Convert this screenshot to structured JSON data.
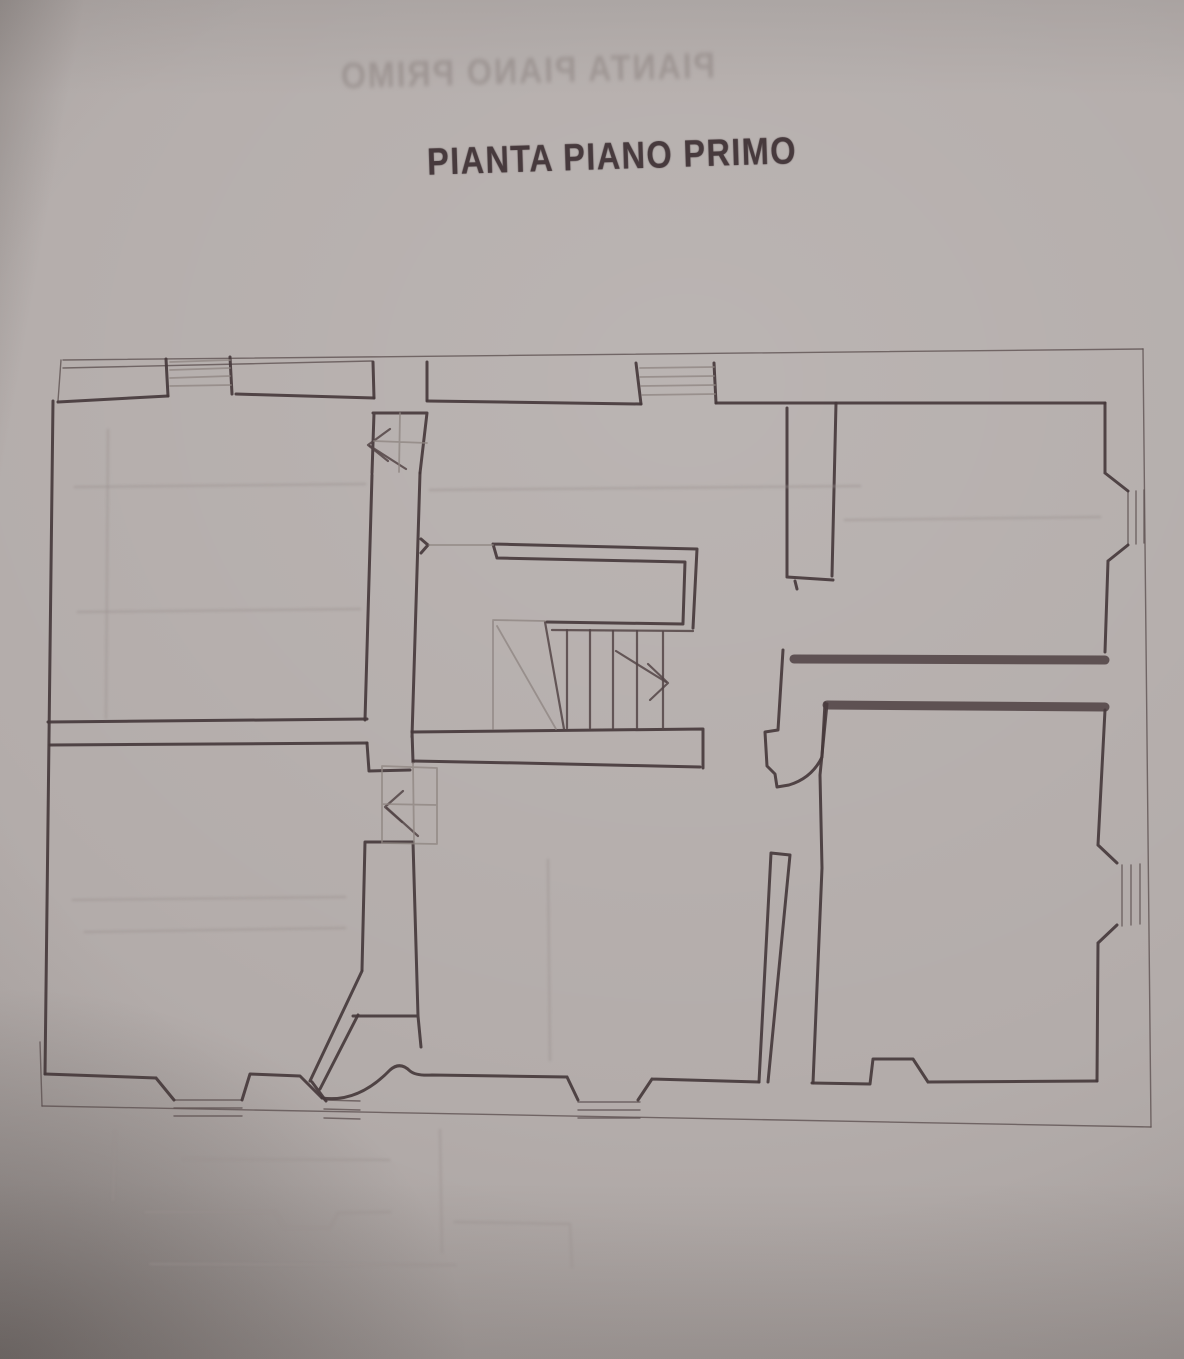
{
  "page": {
    "title": "PIANTA PIANO PRIMO",
    "ghost_title": "PIANTA PIANO PRIMO"
  },
  "colors": {
    "paper": "#b3acaa",
    "ink_wall": "#463a3c",
    "ink_title": "#473a3d",
    "pencil_light": "#8e8480",
    "bleed_ghost": "#9d9492"
  },
  "drawing": {
    "viewbox": "0 0 1184 1359",
    "groups": {
      "thin": [
        {
          "n": "top-wall-outer-line",
          "d": "M63,360 L1143,349"
        },
        {
          "n": "top-wall-outer-line-2",
          "d": "M63,368 L372,361"
        },
        {
          "n": "right-wall-outer-line",
          "d": "M1143,349 L1151,1127"
        },
        {
          "n": "bottom-wall-outer-line",
          "d": "M42,1106 L1151,1127"
        },
        {
          "n": "left-wall-lower-outer-line",
          "d": "M40,1042 L42,1106"
        },
        {
          "n": "top-left-corner-link",
          "d": "M61,360 L58,401"
        },
        {
          "n": "window-bottom-left-a",
          "d": "M174,1100 L242,1100 M174,1108 L242,1108 M174,1116 L242,1116"
        },
        {
          "n": "window-bottom-left-b",
          "d": "M324,1100 L360,1101 M324,1109 L360,1110 M324,1118 L360,1119"
        },
        {
          "n": "window-bottom-center",
          "d": "M578,1102 L640,1102 M578,1110 L640,1110 M578,1118 L640,1118"
        },
        {
          "n": "window-right-upper",
          "d": "M1128,491 L1128,545 M1136,491 L1136,544 M1144,490 L1144,543"
        },
        {
          "n": "window-right-lower",
          "d": "M1122,865 L1122,926 M1131,865 L1131,925 M1140,864 L1140,924"
        }
      ],
      "heavy": [
        {
          "n": "left-exterior-wall",
          "d": "M53,401 L45,1074"
        },
        {
          "n": "top-wall-inner-face",
          "d": "M58,402 L168,396 M236,394 L374,398 M427,401 L641,404 M716,403 L1105,403"
        },
        {
          "n": "top-chimney-left-jambs",
          "d": "M168,396 L166,359 M232,394 L230,357"
        },
        {
          "n": "top-chimney-right-jambs",
          "d": "M641,404 L636,363 M716,403 L714,363"
        },
        {
          "n": "door-top-left-frame",
          "d": "M374,398 L373,362 M427,400 L427,362 M373,413 L427,413 M374,413 L372,473 M427,413 L420,473"
        },
        {
          "n": "top-left-room-right-wall",
          "d": "M372,475 L365,720"
        },
        {
          "n": "stair-hall-left-wall",
          "d": "M420,473 L412,737 M412,731 L413,762"
        },
        {
          "n": "top-left-room-bottom-wall",
          "d": "M48,722 L367,719"
        },
        {
          "n": "bottom-left-room-top-wall",
          "d": "M50,745 L367,743"
        },
        {
          "n": "bottom-left-room-top-step",
          "d": "M367,743 L369,771 L410,770"
        },
        {
          "n": "bottom-left-room-bottom-face",
          "d": "M45,1074 L156,1078 M156,1078 L174,1100"
        },
        {
          "n": "bottom-wall-pier-splays",
          "d": "M242,1100 L250,1074 L300,1076 L322,1098"
        },
        {
          "n": "window-b-left-jamb",
          "d": "M312,1082 L326,1101"
        },
        {
          "n": "bottom-center-inner-face",
          "d": "M322,1098 Q358,1103 390,1070 Q400,1061 410,1071 Q416,1076 432,1075 L567,1077 M567,1077 L578,1100 M638,1100 L652,1079 M652,1079 L759,1082"
        },
        {
          "n": "closet-under-stair",
          "d": "M365,842 L362,970 M365,842 L413,842 M413,842 L418,1016 M353,1016 L418,1016 M418,1016 L421,1047"
        },
        {
          "n": "diagonal-wall",
          "d": "M362,971 L310,1081 M358,1015 L320,1089"
        },
        {
          "n": "stair-hall-bottom-wall",
          "d": "M412,732 L703,729 M413,761 L520,763 L700,767 M703,729 L703,768"
        },
        {
          "n": "stair-enclosure",
          "d": "M493,544 L697,549 M497,558 L685,562 M493,544 L497,558 M697,549 L693,628 M685,562 L683,623 M547,622 L683,624"
        },
        {
          "n": "hall-wall-nib",
          "d": "M421,539 L428,545 M428,545 L421,553"
        },
        {
          "n": "center-thick-wall",
          "d": "M787,408 L787,577 M836,403 L832,576 M787,577 L833,580 M795,581 L797,589"
        },
        {
          "n": "top-right-room-right-face",
          "d": "M1105,403 L1105,473 M1105,473 L1128,491 M1128,545 L1108,561 M1108,561 L1105,652"
        },
        {
          "n": "divider-a-left-end",
          "d": "M783,650 L778,730 L765,732 L767,766 L775,774 L777,787 L789,785 M789,785 Q812,778 822,757 L825,703"
        },
        {
          "n": "right-room-left-wall-line",
          "d": "M827,704 L820,775 L822,868 L813,1083"
        },
        {
          "n": "right-room-right-face",
          "d": "M1105,710 L1098,845 M1098,845 L1117,863 M1117,925 L1098,943 M1098,943 L1097,1081"
        },
        {
          "n": "right-room-bottom-face",
          "d": "M812,1083 L870,1084 M870,1084 L873,1059 L913,1059 L928,1082 M928,1082 L1097,1081"
        },
        {
          "n": "center-finger-wall",
          "d": "M771,853 L759,1082 M771,853 L790,855 M790,855 L768,1082"
        }
      ],
      "band": [
        {
          "n": "divider-wall-a-right-rooms",
          "d": "M794,659 L1105,660"
        },
        {
          "n": "divider-wall-b-right-rooms",
          "d": "M827,705 L1105,707"
        }
      ],
      "medium": [
        {
          "n": "stair-treads",
          "d": "M567,630 L567,728 M590,630 L590,728 M613,631 L613,728 M637,631 L637,729 M663,632 L663,729"
        },
        {
          "n": "stair-winder-line",
          "d": "M545,622 L564,729"
        },
        {
          "n": "stair-lower-bar",
          "d": "M552,630 L693,631"
        },
        {
          "n": "stair-arrow",
          "d": "M648,664 L668,683 L650,700"
        },
        {
          "n": "stair-arrow-tail",
          "d": "M616,651 L666,682"
        },
        {
          "n": "door-top-arrow",
          "d": "M390,429 L368,445 L388,461"
        },
        {
          "n": "door-top-arrow-tail",
          "d": "M370,446 L406,469"
        },
        {
          "n": "door-left-arrow",
          "d": "M403,791 L385,807 L402,822"
        },
        {
          "n": "door-left-arrow-tail",
          "d": "M387,808 L418,836"
        }
      ],
      "light": [
        {
          "n": "top-chimney-left-hatch",
          "d": "M170,362 L230,360 M170,370 L230,368 M170,378 L230,376 M170,386 L231,385"
        },
        {
          "n": "top-chimney-right-hatch",
          "d": "M640,368 L714,367 M640,377 L714,376 M641,386 L715,385 M642,395 L715,394"
        },
        {
          "n": "door-top-leaf",
          "d": "M374,441 L427,443 M400,413 L399,472"
        },
        {
          "n": "door-left-leaf",
          "d": "M382,766 L437,768 M382,843 L437,844 M382,766 L382,843 M437,768 L437,844 M382,804 L437,805 M413,763 L414,842"
        },
        {
          "n": "stair-upper-flight",
          "d": "M429,545 L493,545 M493,620 L545,621 M493,621 L493,729 M497,626 L556,729"
        }
      ],
      "ghost": [
        {
          "n": "bleed-line-left-vert",
          "d": "M115,1132 L113,1200"
        },
        {
          "n": "bleed-line-1",
          "d": "M184,1159 L389,1160"
        },
        {
          "n": "bleed-window-shape",
          "d": "M145,1212 L275,1212 M275,1212 L285,1228 L330,1228 L338,1213 M338,1213 L390,1212"
        },
        {
          "n": "bleed-vert-center",
          "d": "M440,1130 L442,1252"
        },
        {
          "n": "bleed-shape-right",
          "d": "M455,1222 L570,1224 L572,1267"
        },
        {
          "n": "bleed-line-2",
          "d": "M150,1264 L455,1265"
        },
        {
          "n": "bleed-band-top-left-room",
          "d": "M75,487 L365,484 M430,490 L860,486"
        },
        {
          "n": "bleed-line-top-left-room",
          "d": "M78,612 L360,609"
        },
        {
          "n": "bleed-vert-top-left-room",
          "d": "M108,430 L106,718"
        },
        {
          "n": "bleed-line-top-right-room",
          "d": "M845,520 L1100,517"
        },
        {
          "n": "bleed-band-bottom-left",
          "d": "M73,900 L345,897 M85,932 L345,928"
        },
        {
          "n": "bleed-vert-bottom-center",
          "d": "M548,860 L550,1060"
        }
      ]
    }
  }
}
